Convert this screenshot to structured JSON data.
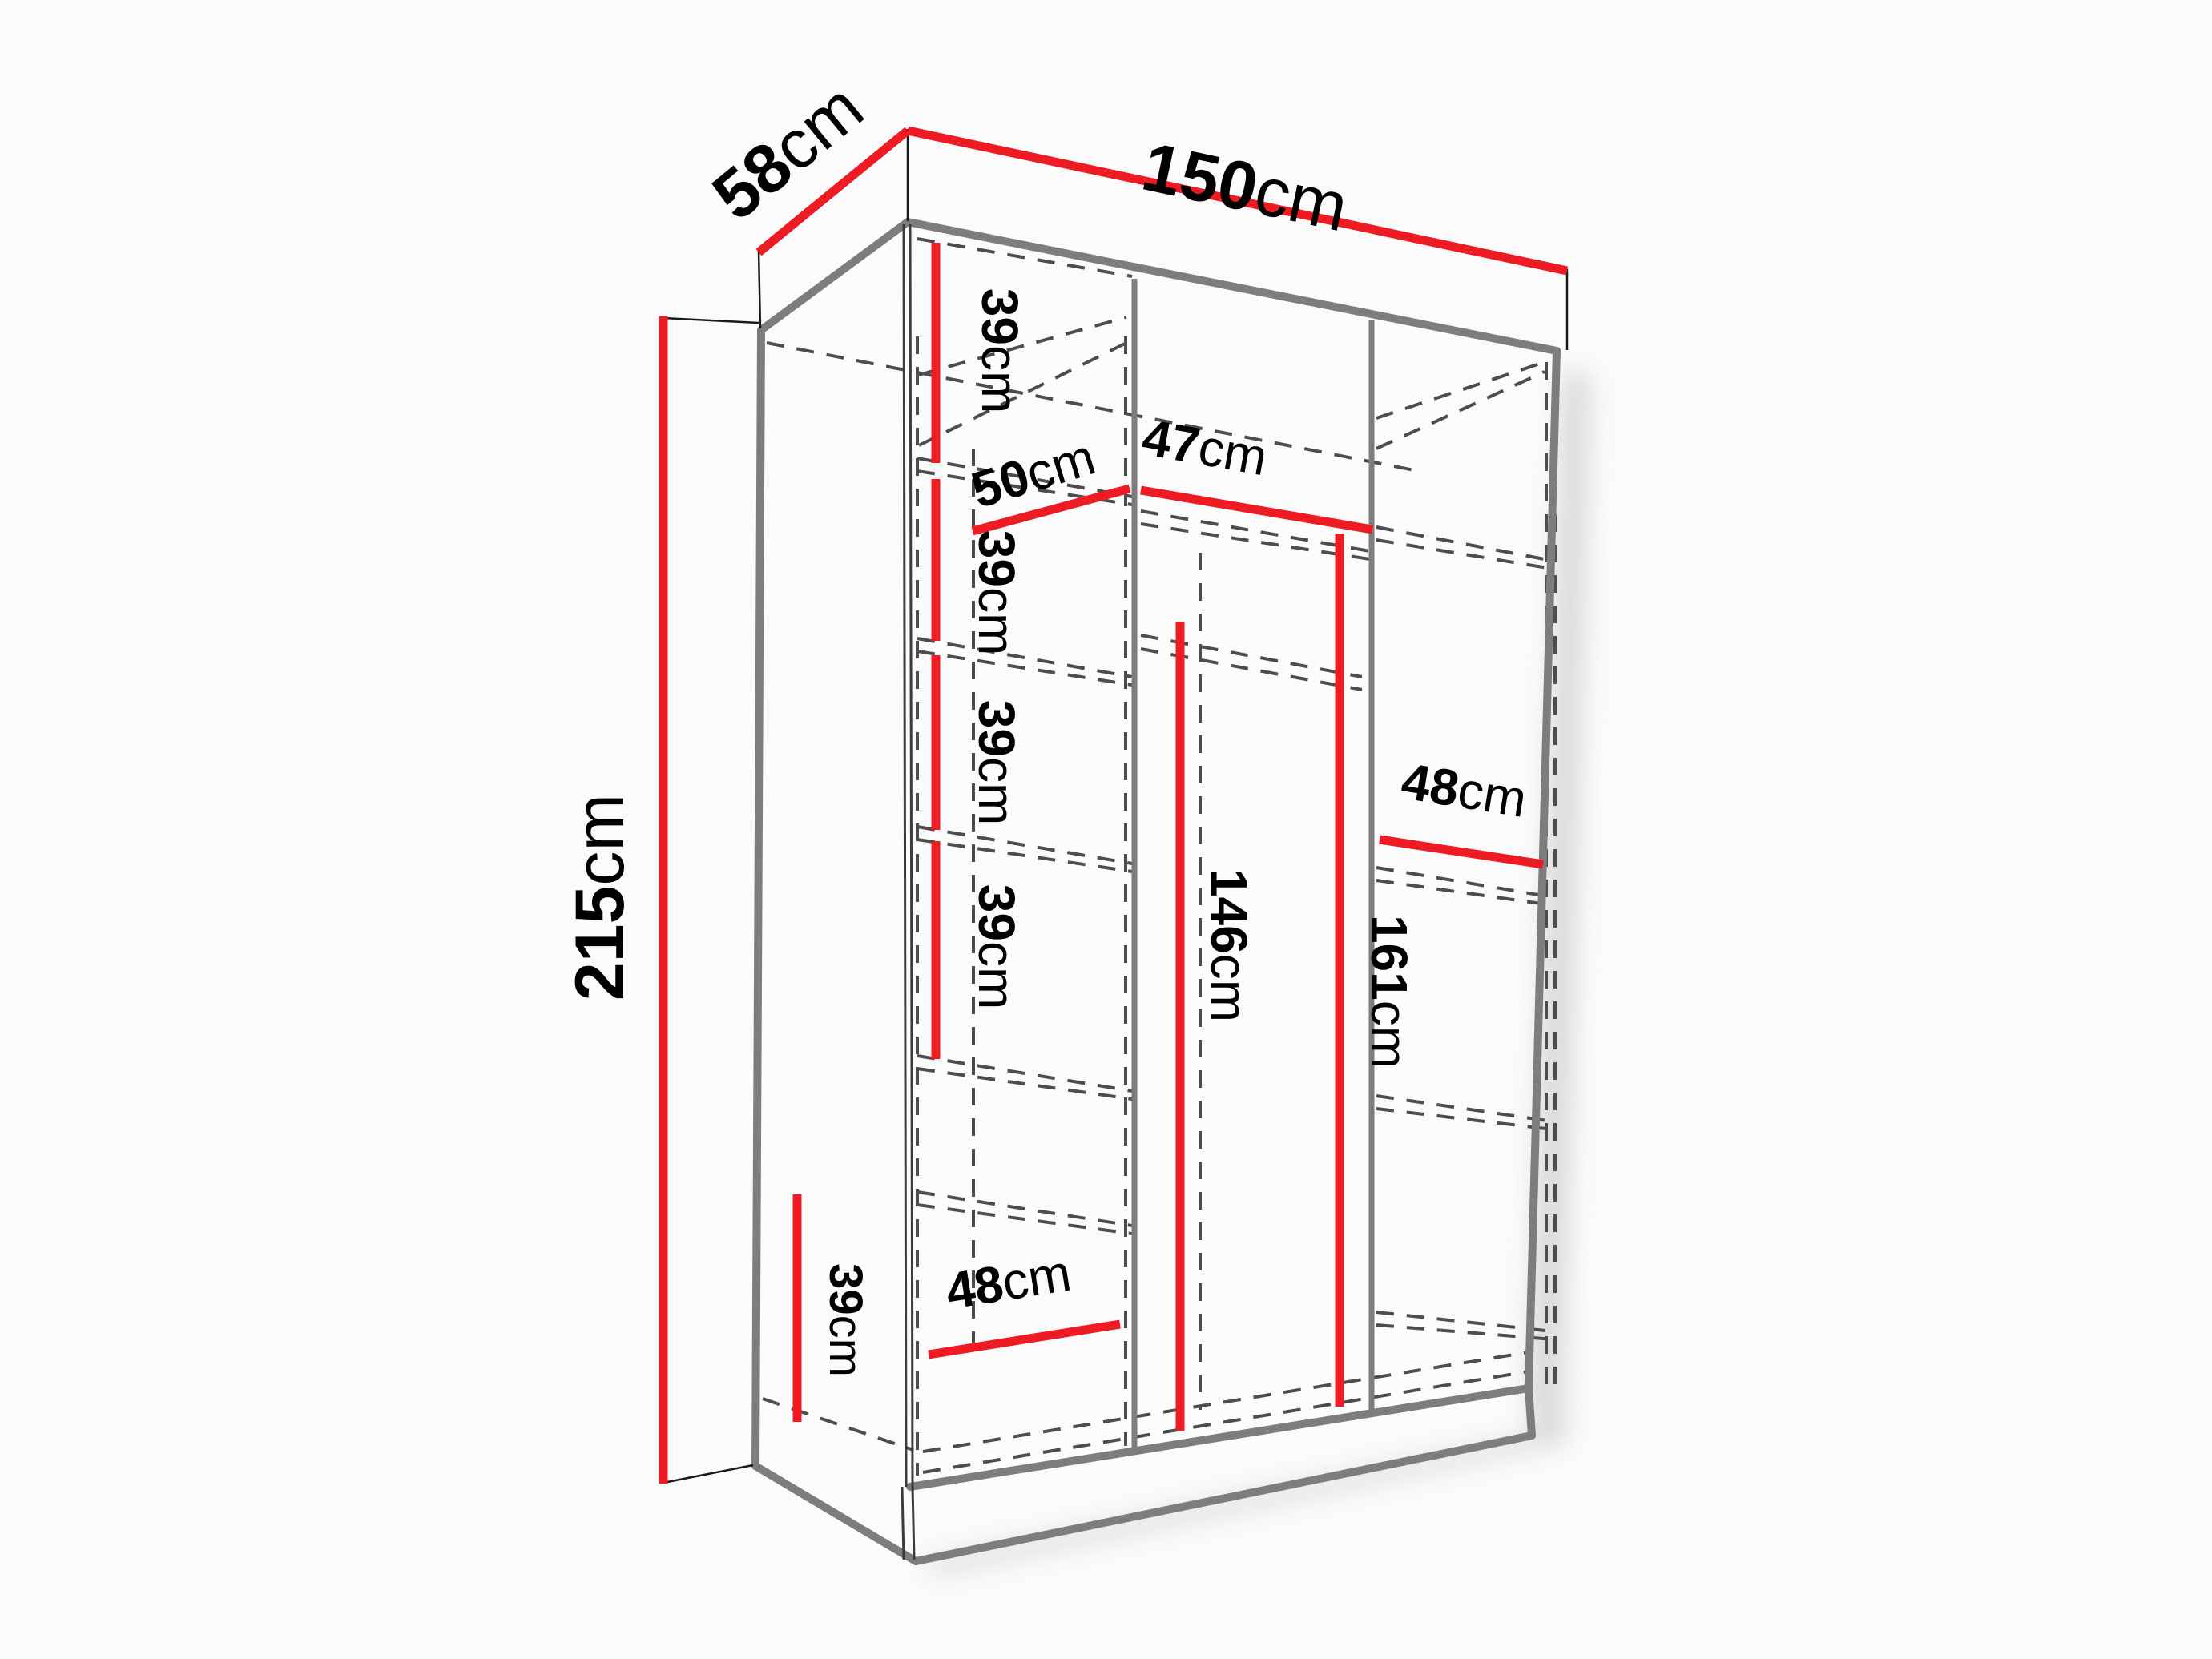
{
  "diagram": {
    "kind": "wardrobe-dimension-diagram",
    "colors": {
      "dimension_red": "#ED1C24",
      "outline_gray": "#7d7d7d",
      "dashed_gray": "#4d4d4d",
      "text": "#000000",
      "background": "#fbfbfb"
    },
    "labels": {
      "depth": {
        "value": "58",
        "unit": "cm"
      },
      "width": {
        "value": "150",
        "unit": "cm"
      },
      "height": {
        "value": "215",
        "unit": "cm"
      },
      "left_shelf_1": {
        "value": "39",
        "unit": "cm"
      },
      "left_shelf_2": {
        "value": "39",
        "unit": "cm"
      },
      "left_shelf_3": {
        "value": "39",
        "unit": "cm"
      },
      "left_shelf_4": {
        "value": "39",
        "unit": "cm"
      },
      "left_shelf_bottom": {
        "value": "39",
        "unit": "cm"
      },
      "left_width_top": {
        "value": "50",
        "unit": "cm"
      },
      "middle_width": {
        "value": "47",
        "unit": "cm"
      },
      "right_width": {
        "value": "48",
        "unit": "cm"
      },
      "left_width_bottom": {
        "value": "48",
        "unit": "cm"
      },
      "hanging_height": {
        "value": "146",
        "unit": "cm"
      },
      "middle_height": {
        "value": "161",
        "unit": "cm"
      }
    }
  }
}
